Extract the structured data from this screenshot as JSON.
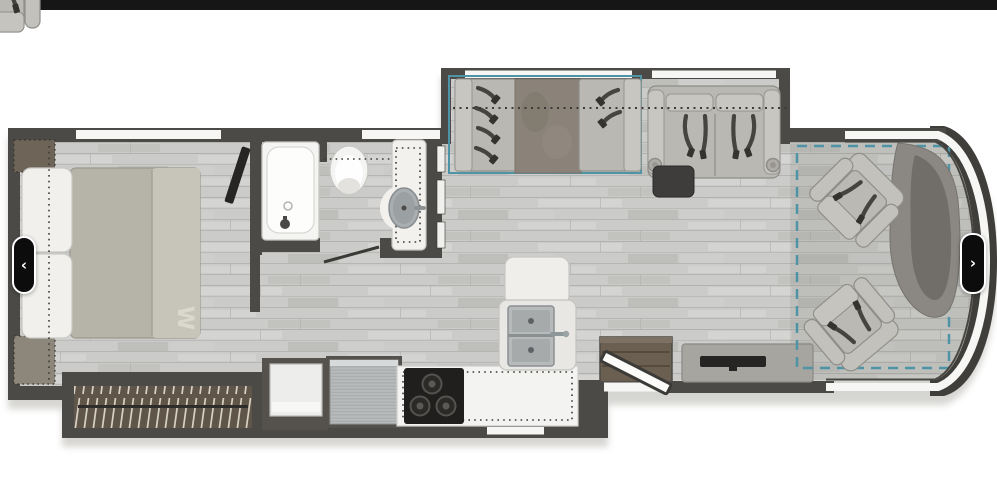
{
  "window": {
    "topbar_color": "#161616",
    "background": "#ffffff"
  },
  "carousel": {
    "prev_icon": "‹",
    "next_icon": "›"
  },
  "floorplan": {
    "bed_monogram": "W",
    "colors": {
      "topbar": "#161616",
      "wall": "#4c4a46",
      "nose_frame": "#3f3e3b",
      "windshield": "#f6f6f4",
      "accent_teal": "#4f93a6",
      "upholstery": "#bab8b2",
      "upholstery_light": "#c8c6c0",
      "dinette_table": "#8b8379",
      "wardrobe_wood": "#5f5549",
      "hanger_line": "#d8d2c4",
      "belt": "#45443f",
      "bed_mattress": "#b6b3a8",
      "bed_foot": "#c7c4b9",
      "pillow": "#f1f0ed",
      "white_fixture": "#f4f4f2",
      "counter": "#f3f3f1",
      "stainless": "#b7bbbc",
      "cooktop": "#201f1d",
      "tv_black": "#262523",
      "ottoman": "#3e3d3b",
      "dashboard": "#8b8883",
      "step_wood": "#6b5f51",
      "nav_button": "#0c0c0c",
      "nav_chevron": "#ffffff",
      "page_bg": "#ffffff"
    }
  }
}
